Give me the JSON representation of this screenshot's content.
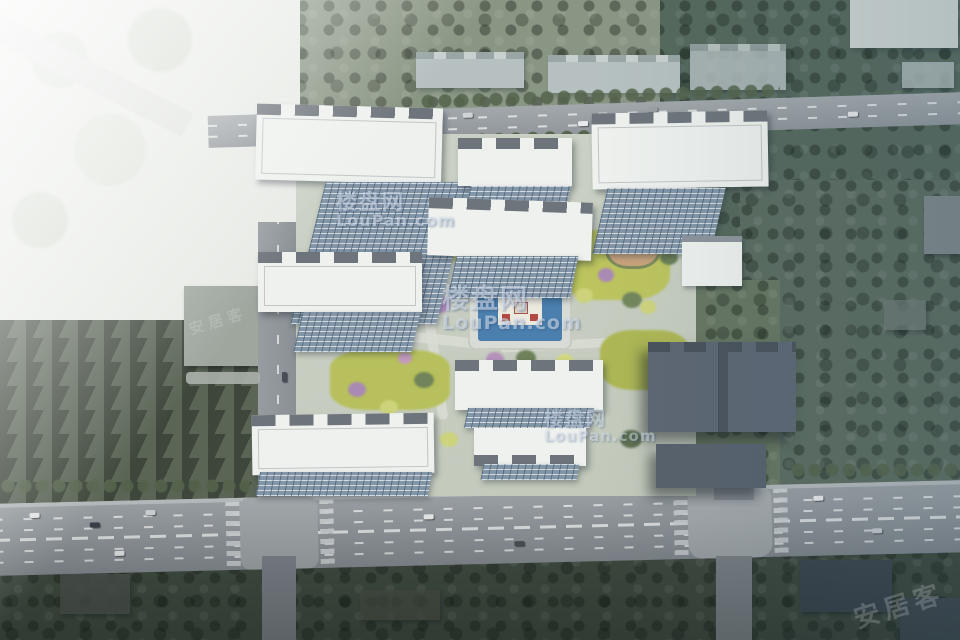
{
  "scene": {
    "title": "residential-complex-aerial-rendering",
    "description": "Bird's-eye masterplan rendering of a residential compound: white apartment slabs with dark articulated roofs and glass facades, central landscaped courtyard with blue plaza pool, perimeter roads with traffic, dense surrounding trees, overexposed white haze at top-left"
  },
  "watermarks": {
    "loupan": {
      "cn": "楼盘网",
      "en": "LouPan.com"
    },
    "anjuke": {
      "text": "安居客"
    }
  },
  "palette": {
    "road": "#8f969b",
    "building_white": "#eef1ee",
    "roof_gray": "#6e747b",
    "facade_glass": "#9db0bf",
    "context_building": "#b6c0c0",
    "dark_building": "#5d6773",
    "tree_green": "#6d7b5e",
    "tree_dark": "#45503f",
    "lawn_yellow": "#bcc45e",
    "tree_purple": "#a98ab4",
    "accent_red": "#a33f35",
    "pool_blue": "#4a7fae",
    "washed_white": "#e9ece8"
  }
}
